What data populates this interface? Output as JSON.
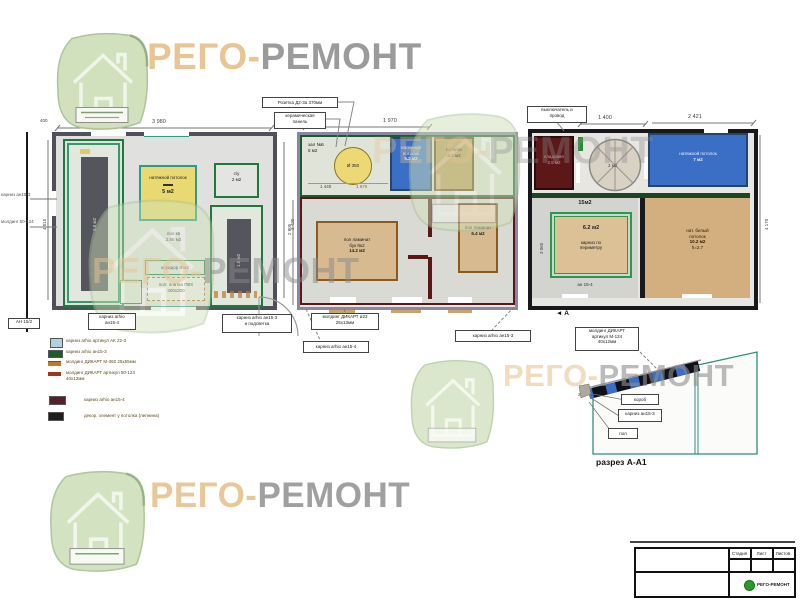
{
  "brand": {
    "prefix": "РЕГО-",
    "suffix": "РЕМОНТ",
    "prefix_color": "#e7c693",
    "suffix_color": "#9b9b9b"
  },
  "plan1": {
    "dim_400": "400",
    "dim_top": "3 980",
    "dim_left": "4 015",
    "dim_right": "3 420",
    "note_left1": "карниз ан15-3",
    "note_left2": "молдинг 50-124",
    "tag": "АН 15/2",
    "wardrobe_area": "2.6 м2",
    "yellow_line1": "натяжной потолок",
    "yellow_area": "5 м2",
    "mid_line1": "пол кв",
    "mid_line2": "2.85 м2",
    "wc_line1": "с/у",
    "wc_line2": "2 м2",
    "right_area": "1.5 м2",
    "corridor": "коридор 4 м2",
    "floor_line1": "пол: плитка ПВХ",
    "floor_line2": "300х300",
    "label_left_line1": "карниз arhio",
    "label_left_line2": "ан15-4",
    "label_right_line1": "карниз arhio ан15-3",
    "label_right_line2": "и подсветка"
  },
  "plan2": {
    "dim_top": "1 970",
    "dim_left": "2 805",
    "hall_line1": "зал №6",
    "hall_line2": "5 м2",
    "circle_label": "Ø 350",
    "dim_a": "1 440",
    "dim_b": "1 670",
    "blue_line1": "натяжной",
    "blue_line2": "потолок",
    "blue_area": "5.2 м2",
    "tan_line1": "потолок",
    "tan_area": "4.1 м2",
    "big_line1": "пол ламинат",
    "big_line2": "бук №2",
    "big_area": "14.2 м2",
    "right_line1": "пол ламинат",
    "right_area": "6.4 м2",
    "callout1": "Розетка Д2-3а 370мм",
    "callout2_line1": "керамическая",
    "callout2_line2": "панель",
    "label_mold_line1": "молдинг ДИКАРТ ø23",
    "label_mold_line2": "25х13мм",
    "label_corn4": "карниз arhio ан15-4",
    "label_corn3": "карниз arhio ан15-3"
  },
  "plan3": {
    "dim_top_a": "1 400",
    "dim_top_b": "2 421",
    "dim_right": "4 170",
    "dim_inner": "3 065",
    "callout_line1": "выключатель и",
    "callout_line2": "провод",
    "storage_line1": "кладовая",
    "storage_line2": "2.5 м2",
    "fan_area": "2 м2",
    "blue_line1": "натяжной потолок",
    "blue_area": "7 м2",
    "room_area": "15м2",
    "inner_area": "6.2 м2",
    "inner_line1": "карниз по",
    "inner_line2": "периметру",
    "inner_bottom": "ан 15-4",
    "big_line1": "нат. белый",
    "big_line2": "потолок",
    "big_area": "10.2 м2",
    "big_h": "h=2.7",
    "marker": "◄ А",
    "label_m124_line1": "молдинг ДИКАРТ",
    "label_m124_line2": "артикул М-124",
    "label_m124_line3": "40х12мм"
  },
  "legend": {
    "items": [
      {
        "swatch": "#aed3dc",
        "text": "карниз arhio артикул АК 22-3"
      },
      {
        "swatch": "#1c5c2c",
        "text": "карниз arhio ан15-3"
      },
      {
        "swatch": "#c4762a",
        "text": "молдинг ДИКАРТ М-360 25х55мм"
      },
      {
        "swatch": "#a03618",
        "text": "молдинг ДИКАРТ артикул 50-124 40х12мм"
      },
      {
        "swatch": "#56202a",
        "text": "карниз arhio ан15-4"
      },
      {
        "swatch": "#1e1e1e",
        "text": "декор. элемент у потолка (лепнина)"
      }
    ]
  },
  "section": {
    "title": "разрез А-А1",
    "dim": "200",
    "callout_box": "короб",
    "callout_cornice": "карниз ан15-3",
    "callout_floor": "пол"
  },
  "titleblock": {
    "col1": "Стадия",
    "col2": "Лист",
    "col3": "Листов",
    "logo_text": "РЕГО-РЕМОНТ"
  },
  "colors": {
    "blue_room": "#3b6ec5",
    "tan_room": "#d7ba90",
    "yellow_room": "#ead973",
    "maroon_wall": "#5c1616",
    "green_cornice": "#1e7a3c",
    "teal_section": "#2f8f7a",
    "watermark_green": "#cfe0bb"
  }
}
